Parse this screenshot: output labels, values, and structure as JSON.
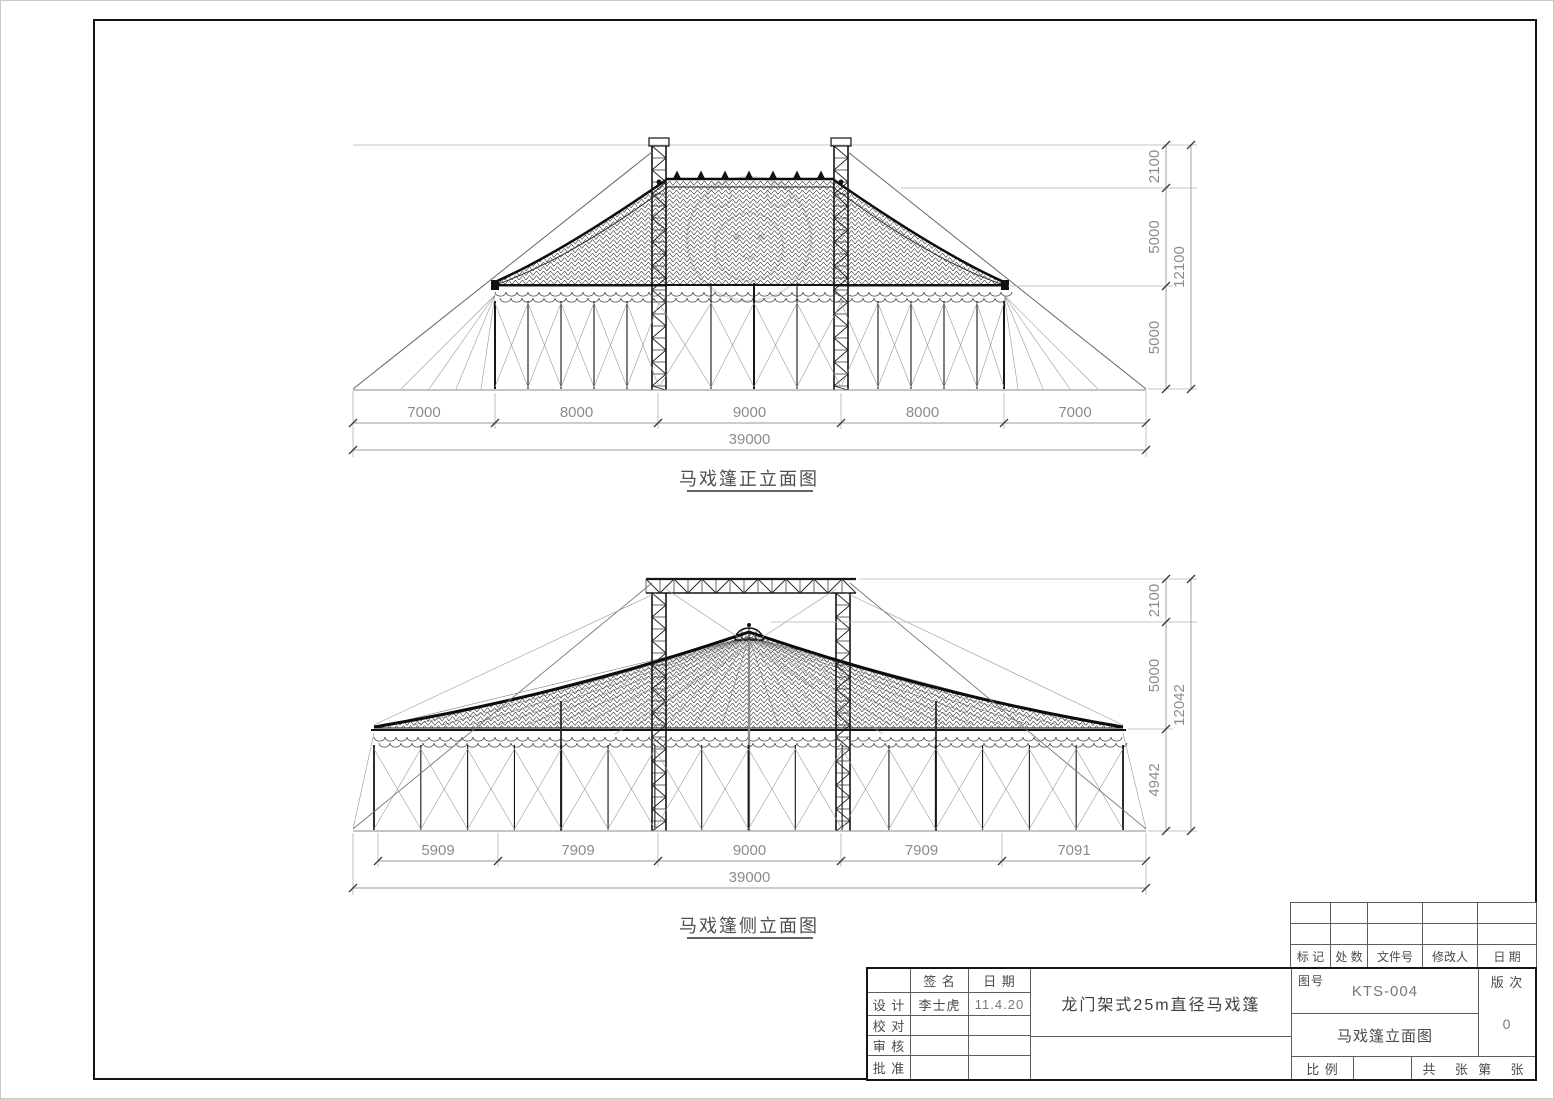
{
  "front_view": {
    "title": "马戏篷正立面图",
    "span_dims": [
      "7000",
      "8000",
      "9000",
      "8000",
      "7000"
    ],
    "span_total": "39000",
    "height_dims": [
      "2100",
      "5000",
      "5000"
    ],
    "height_total": "12100"
  },
  "side_view": {
    "title": "马戏篷侧立面图",
    "span_dims": [
      "5909",
      "7909",
      "9000",
      "7909",
      "7091"
    ],
    "span_total": "39000",
    "height_dims": [
      "2100",
      "5000",
      "4942"
    ],
    "height_total": "12042"
  },
  "title_block": {
    "sign_col_header": "签 名",
    "date_col_header": "日 期",
    "rows": [
      {
        "label": "设 计",
        "name": "李士虎",
        "date": "11.4.20"
      },
      {
        "label": "校 对",
        "name": "",
        "date": ""
      },
      {
        "label": "审 核",
        "name": "",
        "date": ""
      },
      {
        "label": "批 准",
        "name": "",
        "date": ""
      }
    ],
    "project_title": "龙门架式25m直径马戏篷",
    "revision_header": [
      "标 记",
      "处 数",
      "文件号",
      "修改人",
      "日 期"
    ],
    "drawing_no_label": "图号",
    "drawing_no": "KTS-004",
    "revision_label": "版 次",
    "revision_value": "0",
    "drawing_name": "马戏篷立面图",
    "scale_label": "比 例",
    "sheets_label": "共    张  第    张"
  }
}
